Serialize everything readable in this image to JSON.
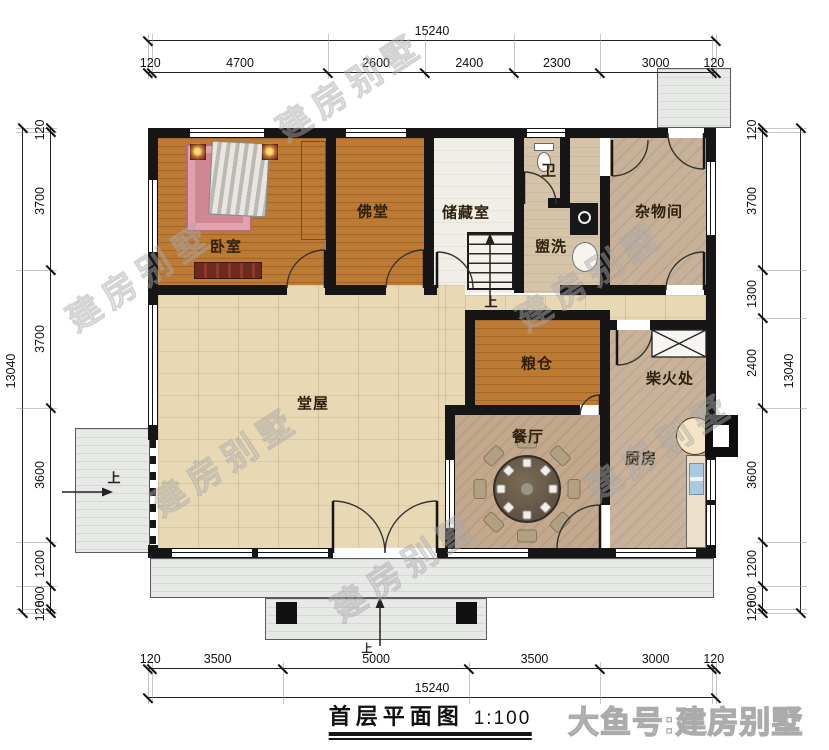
{
  "title": {
    "text": "首层平面图",
    "scale": "1:100"
  },
  "watermark": {
    "diagonal": "建房别墅",
    "corner": "大鱼号:建房别墅"
  },
  "dimensions": {
    "top": {
      "total": "15240",
      "segments": [
        "120",
        "4700",
        "2600",
        "2400",
        "2300",
        "3000",
        "120"
      ]
    },
    "bottom": {
      "total": "15240",
      "segments": [
        "120",
        "3500",
        "5000",
        "3500",
        "3000",
        "120"
      ]
    },
    "left": {
      "total": "13040",
      "segments": [
        "120",
        "3700",
        "3700",
        "3600",
        "1200",
        "600",
        "120"
      ]
    },
    "right": {
      "total": "13040",
      "segments": [
        "120",
        "3700",
        "1300",
        "2400",
        "3600",
        "1200",
        "600",
        "120"
      ]
    }
  },
  "rooms": {
    "bedroom": "卧室",
    "buddha_hall": "佛堂",
    "storage": "储藏室",
    "toilet": "卫",
    "wash": "盥洗",
    "utility": "杂物间",
    "main_hall": "堂屋",
    "granary": "粮仓",
    "firewood": "柴火处",
    "dining": "餐厅",
    "kitchen": "厨房"
  },
  "annotations": {
    "up": "上"
  },
  "colors": {
    "wall": "#161616",
    "wood_orange": "#bd7a33",
    "hall_floor": "#e9d8b4",
    "tan_floor": "#d6c4aa",
    "utility_floor": "#c8b199",
    "dining_floor": "#c2a98d",
    "kitchen_floor": "#c9b29a",
    "storage_floor": "#f0eee7",
    "porch": "#e7e9e6",
    "rug_pink": "#cf8793",
    "sink_blue": "#a9cbe2"
  }
}
